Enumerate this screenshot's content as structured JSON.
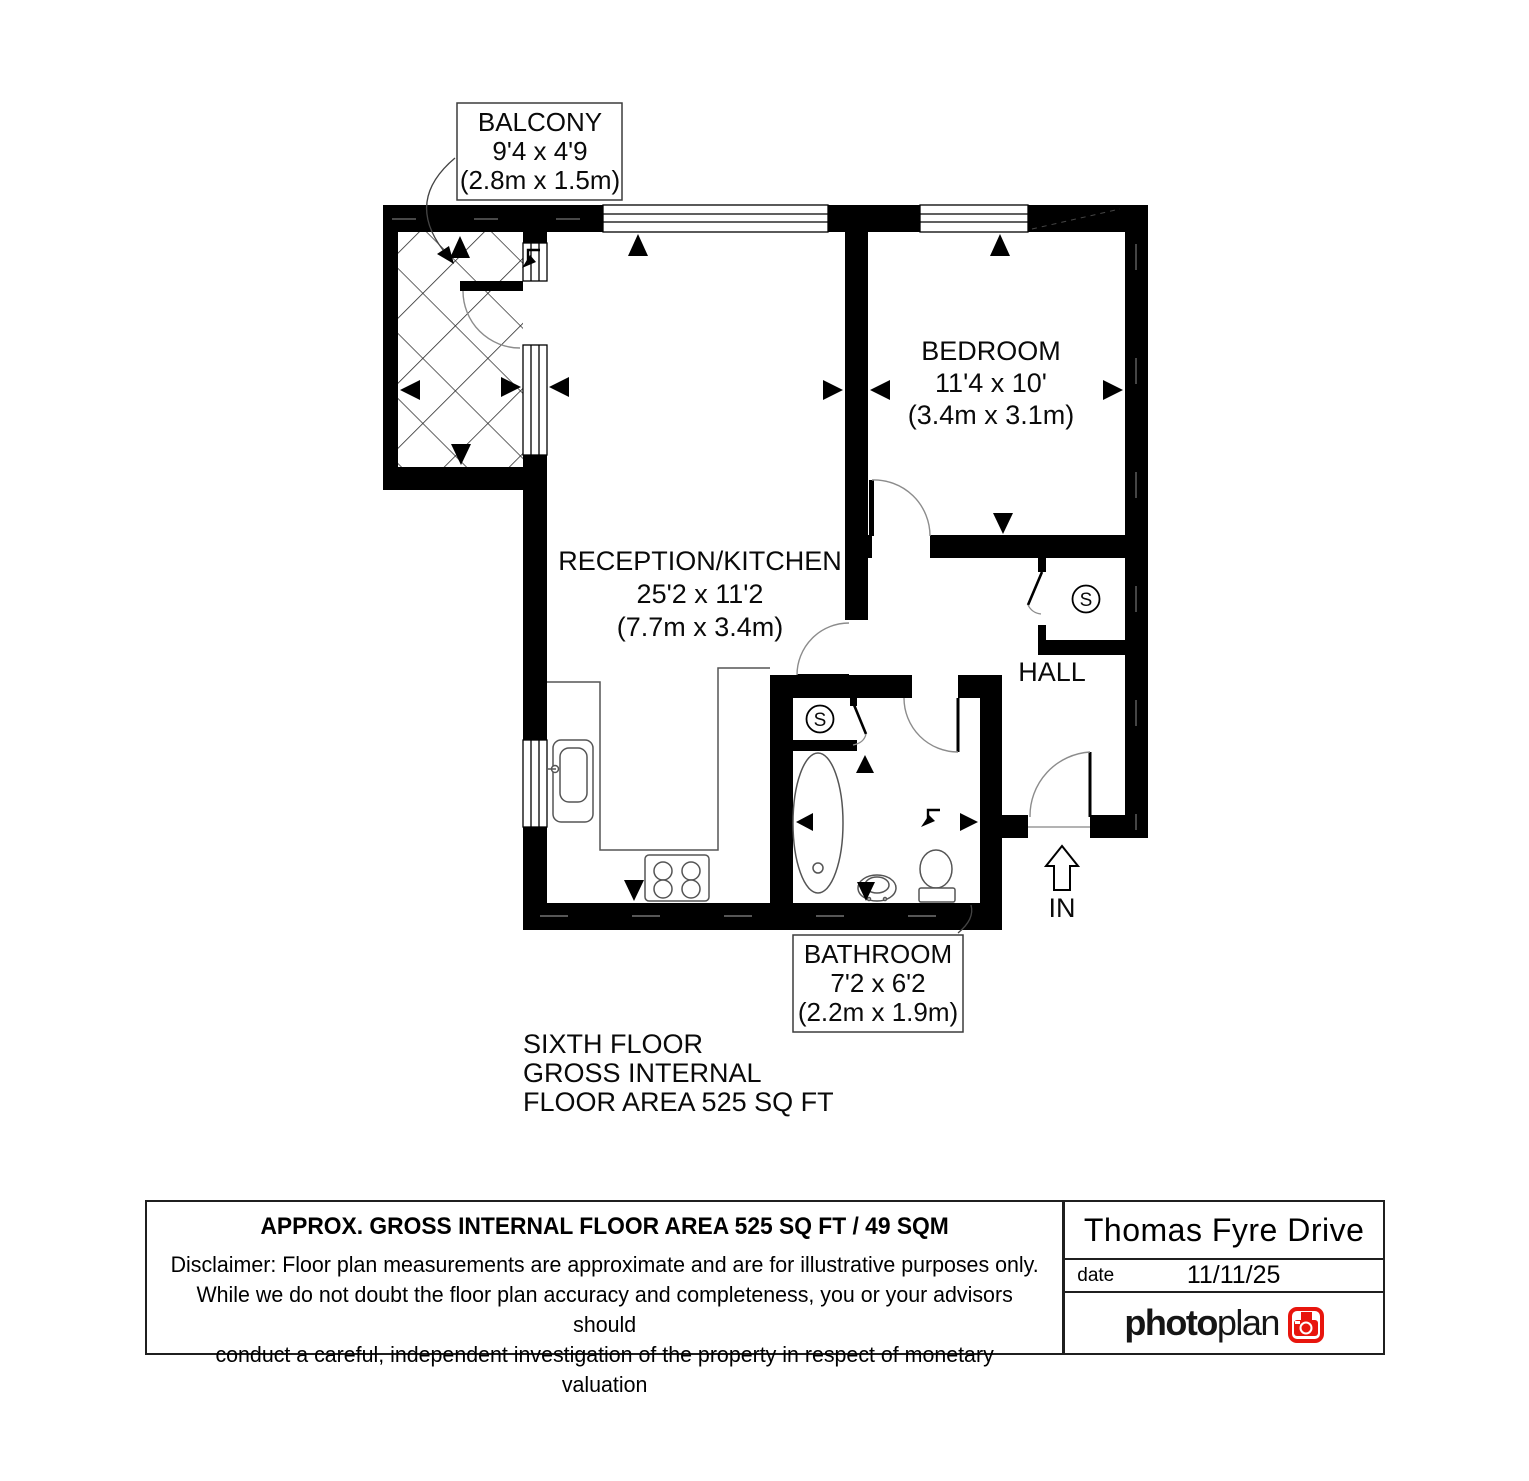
{
  "document_type": "floor-plan",
  "colors": {
    "walls": "#000000",
    "brand_red": "#e8150d",
    "paper": "#ffffff"
  },
  "plan": {
    "rooms": {
      "balcony": {
        "name": "BALCONY",
        "size_imperial": "9'4 x 4'9",
        "size_metric": "(2.8m x 1.5m)"
      },
      "reception": {
        "name": "RECEPTION/KITCHEN",
        "size_imperial": "25'2 x 11'2",
        "size_metric": "(7.7m x 3.4m)"
      },
      "bedroom": {
        "name": "BEDROOM",
        "size_imperial": "11'4 x 10'",
        "size_metric": "(3.4m x 3.1m)"
      },
      "bathroom": {
        "name": "BATHROOM",
        "size_imperial": "7'2 x 6'2",
        "size_metric": "(2.2m x 1.9m)"
      },
      "hall": {
        "name": "HALL"
      }
    },
    "storage_symbol": "S",
    "entrance_label": "IN"
  },
  "floor_summary": {
    "line1": "SIXTH FLOOR",
    "line2": "GROSS INTERNAL",
    "line3": "FLOOR AREA 525 SQ FT"
  },
  "footer": {
    "area_heading": "APPROX. GROSS INTERNAL FLOOR AREA 525 SQ FT / 49 SQM",
    "disclaimer_line1": "Disclaimer: Floor plan measurements are approximate and are for illustrative purposes only.",
    "disclaimer_line2": "While we do not doubt the floor plan accuracy and completeness, you or your advisors should",
    "disclaimer_line3": "conduct a careful, independent investigation of the property in respect of monetary valuation",
    "address": "Thomas Fyre Drive",
    "date_label": "date",
    "date_value": "11/11/25",
    "brand": {
      "word_bold": "photo",
      "word_regular": "plan"
    }
  }
}
